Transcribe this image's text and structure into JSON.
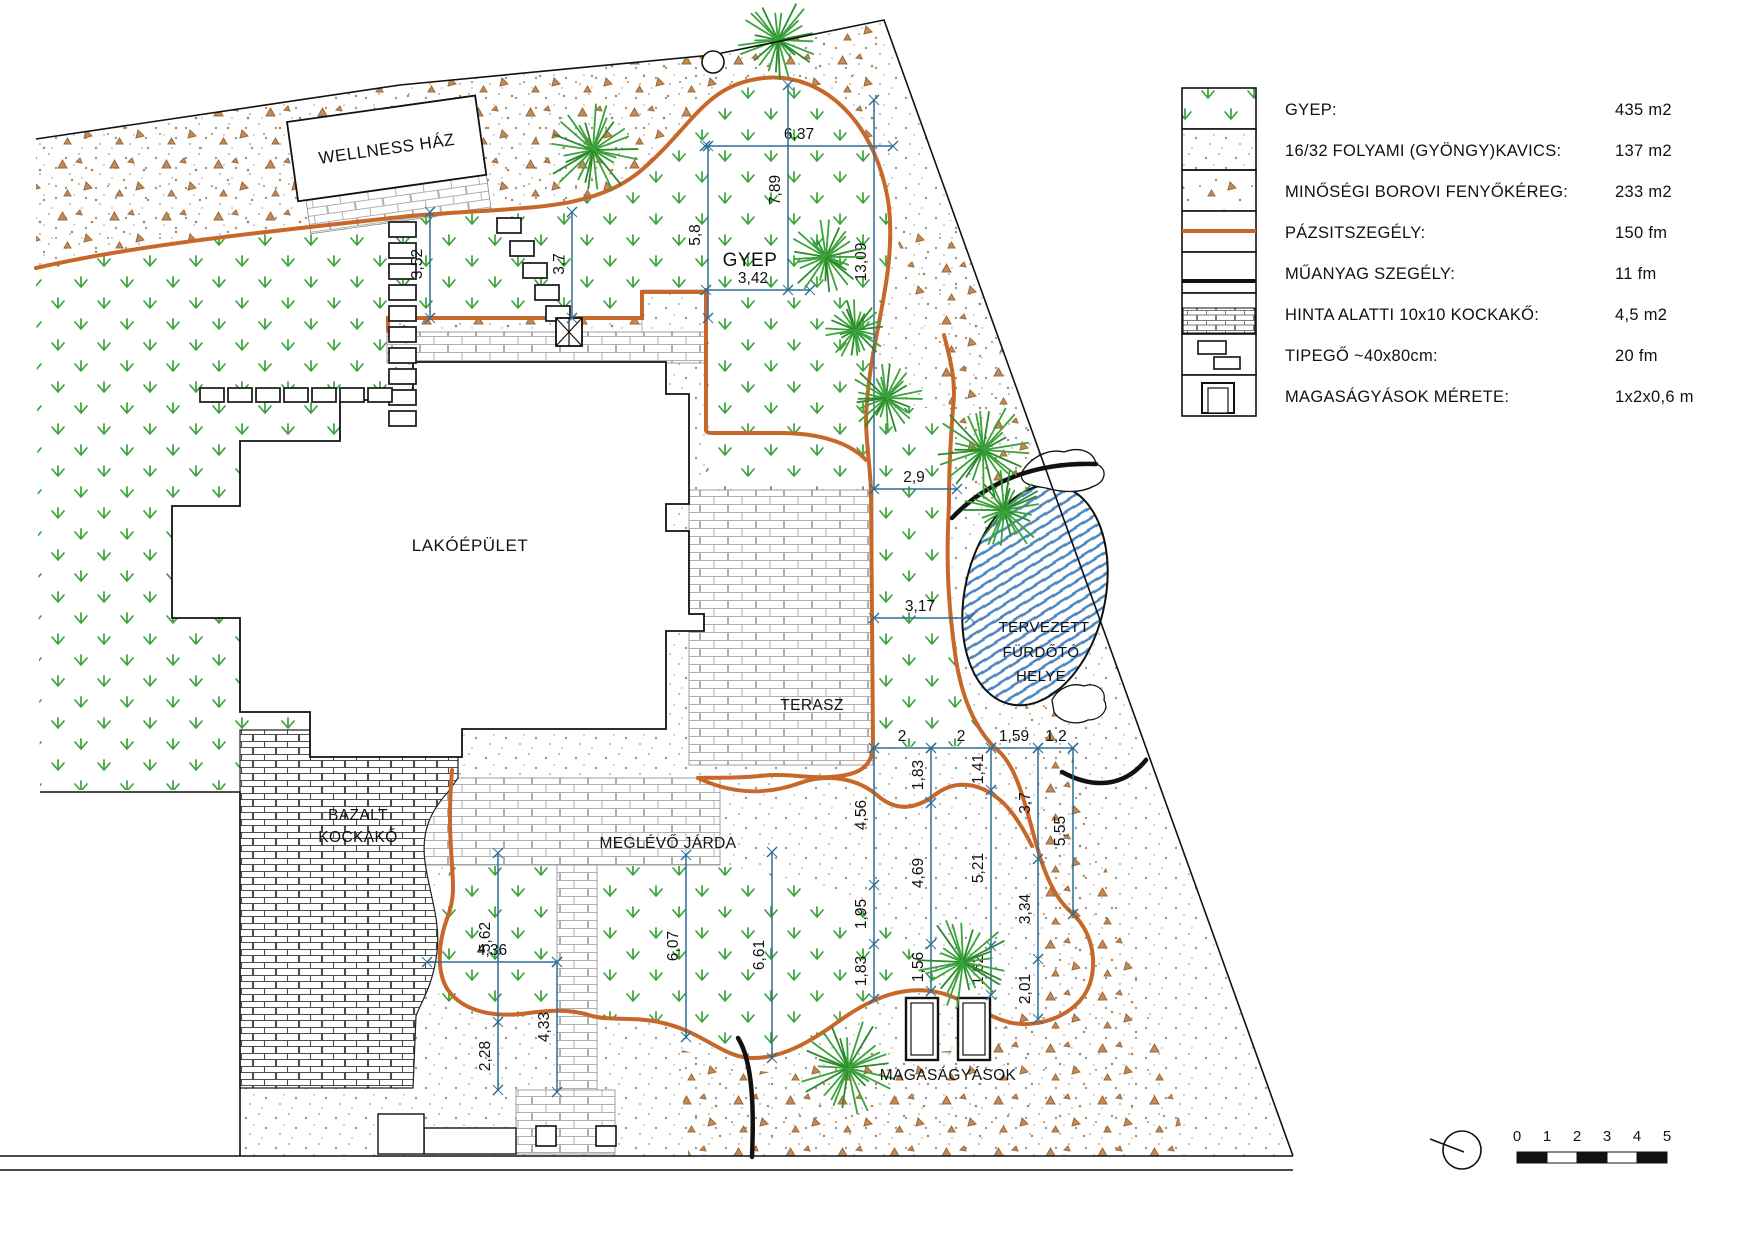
{
  "legend": {
    "rows": [
      {
        "label": "GYEP:",
        "value": "435 m2",
        "swatch": "grass"
      },
      {
        "label": "16/32 FOLYAMI (GYÖNGY)KAVICS:",
        "value": "137 m2",
        "swatch": "pebble"
      },
      {
        "label": "MINŐSÉGI BOROVI FENYŐKÉREG:",
        "value": "233 m2",
        "swatch": "bark"
      },
      {
        "label": "PÁZSITSZEGÉLY:",
        "value": "150 fm",
        "swatch": "lawn-edge"
      },
      {
        "label": "MŰANYAG SZEGÉLY:",
        "value": "11 fm",
        "swatch": "plastic-edge"
      },
      {
        "label": "HINTA ALATTI 10x10 KOCKAKŐ:",
        "value": "4,5 m2",
        "swatch": "cobble"
      },
      {
        "label": "TIPEGŐ ~40x80cm:",
        "value": "20 fm",
        "swatch": "stepping-stone"
      },
      {
        "label": "MAGASÁGYÁSOK MÉRETE:",
        "value": "1x2x0,6 m",
        "swatch": "raised-bed"
      }
    ]
  },
  "plan": {
    "labels": {
      "wellness": "WELLNESS HÁZ",
      "house": "LAKÓÉPÜLET",
      "terrace": "TERASZ",
      "gyep": "GYEP",
      "bazalt1": "BAZALT",
      "bazalt2": "KOCKAKŐ",
      "jarda": "MEGLÉVŐ JÁRDA",
      "pond1": "TERVEZETT",
      "pond2": "FÜRDŐTÓ",
      "pond3": "HELYE",
      "beds": "MAGASÁGYÁSOK"
    },
    "dims": [
      {
        "o": "h",
        "at": 146,
        "a": 705,
        "b": 893,
        "t": [],
        "L": [
          [
            "6,37",
            799
          ]
        ]
      },
      {
        "o": "v",
        "at": 708,
        "a": 146,
        "b": 318,
        "t": [],
        "L": [
          [
            "5,8",
            235
          ]
        ]
      },
      {
        "o": "v",
        "at": 788,
        "a": 85,
        "b": 290,
        "t": [],
        "L": [
          [
            "7,89",
            190
          ]
        ]
      },
      {
        "o": "v",
        "at": 874,
        "a": 100,
        "b": 489,
        "t": [],
        "L": [
          [
            "13,09",
            262
          ]
        ]
      },
      {
        "o": "h",
        "at": 290,
        "a": 706,
        "b": 810,
        "t": [],
        "L": [
          [
            "3,42",
            753
          ]
        ]
      },
      {
        "o": "h",
        "at": 489,
        "a": 874,
        "b": 957,
        "t": [],
        "L": [
          [
            "2,9",
            914
          ]
        ]
      },
      {
        "o": "h",
        "at": 618,
        "a": 874,
        "b": 970,
        "t": [],
        "L": [
          [
            "3,17",
            920
          ]
        ]
      },
      {
        "o": "v",
        "at": 430,
        "a": 212,
        "b": 318,
        "t": [],
        "L": [
          [
            "3,52",
            264
          ]
        ]
      },
      {
        "o": "v",
        "at": 572,
        "a": 212,
        "b": 318,
        "t": [],
        "L": [
          [
            "3,7",
            264
          ]
        ]
      },
      {
        "o": "h",
        "at": 748,
        "a": 874,
        "b": 1073,
        "t": [
          931,
          991,
          1038
        ],
        "L": [
          [
            "2",
            902
          ],
          [
            "2",
            961
          ],
          [
            "1,59",
            1014
          ],
          [
            "1,2",
            1056
          ]
        ]
      },
      {
        "o": "v",
        "at": 874,
        "a": 748,
        "b": 999,
        "t": [
          885,
          944
        ],
        "L": [
          [
            "4,56",
            815
          ],
          [
            "1,95",
            914
          ],
          [
            "1,83",
            971
          ]
        ]
      },
      {
        "o": "v",
        "at": 931,
        "a": 748,
        "b": 991,
        "t": [
          803,
          944
        ],
        "L": [
          [
            "1,83",
            775
          ],
          [
            "4,69",
            873
          ],
          [
            "1,56",
            967
          ]
        ]
      },
      {
        "o": "v",
        "at": 991,
        "a": 748,
        "b": 995,
        "t": [
          790,
          946
        ],
        "L": [
          [
            "1,41",
            769
          ],
          [
            "5,21",
            868
          ],
          [
            "1,62",
            970
          ]
        ]
      },
      {
        "o": "v",
        "at": 1038,
        "a": 748,
        "b": 1019,
        "t": [
          859,
          959
        ],
        "L": [
          [
            "3,7",
            803
          ],
          [
            "3,34",
            909
          ],
          [
            "2,01",
            989
          ]
        ]
      },
      {
        "o": "v",
        "at": 1073,
        "a": 748,
        "b": 914,
        "t": [],
        "L": [
          [
            "5,55",
            831
          ]
        ]
      },
      {
        "o": "v",
        "at": 686,
        "a": 855,
        "b": 1037,
        "t": [],
        "L": [
          [
            "6,07",
            946
          ]
        ]
      },
      {
        "o": "v",
        "at": 772,
        "a": 852,
        "b": 1058,
        "t": [],
        "L": [
          [
            "6,61",
            955
          ]
        ]
      },
      {
        "o": "v",
        "at": 498,
        "a": 853,
        "b": 1090,
        "t": [
          1022
        ],
        "L": [
          [
            "5,62",
            937
          ],
          [
            "2,28",
            1056
          ]
        ]
      },
      {
        "o": "h",
        "at": 962,
        "a": 427,
        "b": 557,
        "t": [],
        "L": [
          [
            "4,36",
            492
          ]
        ]
      },
      {
        "o": "v",
        "at": 557,
        "a": 962,
        "b": 1092,
        "t": [],
        "L": [
          [
            "4,33",
            1027
          ]
        ]
      }
    ],
    "plants": [
      [
        593,
        150,
        46
      ],
      [
        778,
        40,
        40
      ],
      [
        826,
        257,
        38
      ],
      [
        855,
        330,
        30
      ],
      [
        886,
        398,
        36
      ],
      [
        983,
        450,
        48
      ],
      [
        1004,
        510,
        40
      ],
      [
        848,
        1068,
        48
      ],
      [
        963,
        962,
        46
      ]
    ],
    "stones": [
      [
        389,
        222,
        27,
        15
      ],
      [
        389,
        243,
        27,
        15
      ],
      [
        389,
        264,
        27,
        15
      ],
      [
        389,
        285,
        27,
        15
      ],
      [
        389,
        306,
        27,
        15
      ],
      [
        389,
        327,
        27,
        15
      ],
      [
        389,
        348,
        27,
        15
      ],
      [
        389,
        369,
        27,
        15
      ],
      [
        389,
        390,
        27,
        15
      ],
      [
        389,
        411,
        27,
        15
      ],
      [
        200,
        388,
        24,
        14
      ],
      [
        228,
        388,
        24,
        14
      ],
      [
        256,
        388,
        24,
        14
      ],
      [
        284,
        388,
        24,
        14
      ],
      [
        312,
        388,
        24,
        14
      ],
      [
        340,
        388,
        24,
        14
      ],
      [
        368,
        388,
        24,
        14
      ],
      [
        497,
        218,
        24,
        15
      ],
      [
        510,
        241,
        24,
        15
      ],
      [
        523,
        263,
        24,
        15
      ],
      [
        535,
        285,
        24,
        15
      ],
      [
        546,
        306,
        24,
        15
      ]
    ]
  },
  "scalebar": {
    "ticks": [
      "0",
      "1",
      "2",
      "3",
      "4",
      "5"
    ]
  },
  "colors": {
    "edging": "#c8672a",
    "plastic_edge": "#111111",
    "dimension": "#2e6e96",
    "grass": "#3aa33a",
    "bark": "#b5824d",
    "pond_hatch": "#4d86bf"
  }
}
